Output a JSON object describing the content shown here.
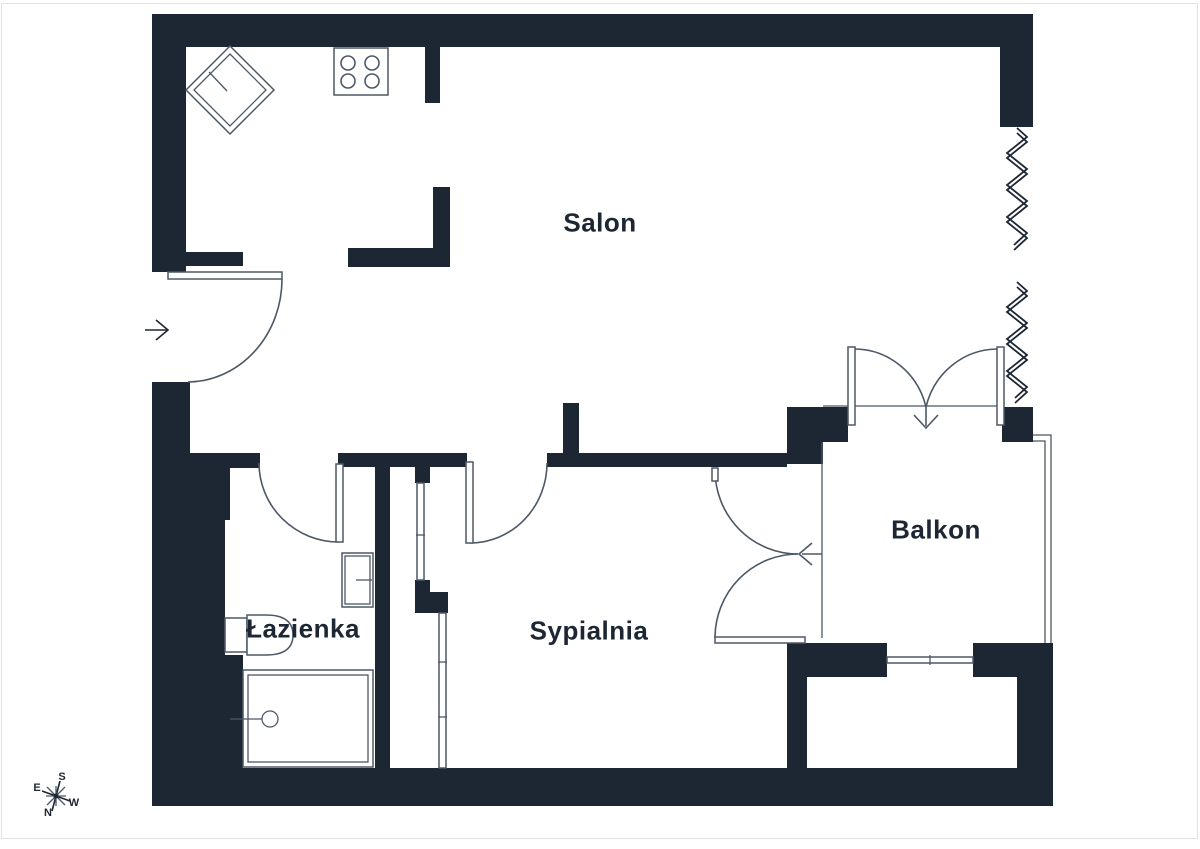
{
  "plan": {
    "type": "apartment-floor-plan"
  },
  "rooms": {
    "salon": {
      "label": "Salon"
    },
    "sypialnia": {
      "label": "Sypialnia"
    },
    "lazienka": {
      "label": "Łazienka"
    },
    "balkon": {
      "label": "Balkon"
    }
  },
  "compass": {
    "s": "S",
    "e": "E",
    "w": "W",
    "n": "N"
  },
  "icons": [
    "stove-icon",
    "kitchen-sink-icon",
    "washbasin-icon",
    "toilet-icon",
    "shower-icon",
    "entry-arrow-icon",
    "compass-rose-icon",
    "window-zigzag-icon",
    "door-swing-arc"
  ],
  "colors": {
    "wall": "#1d2733",
    "line": "#4d5866",
    "text": "#1d2733",
    "bg": "#ffffff",
    "page_border": "#e2e2e2"
  }
}
